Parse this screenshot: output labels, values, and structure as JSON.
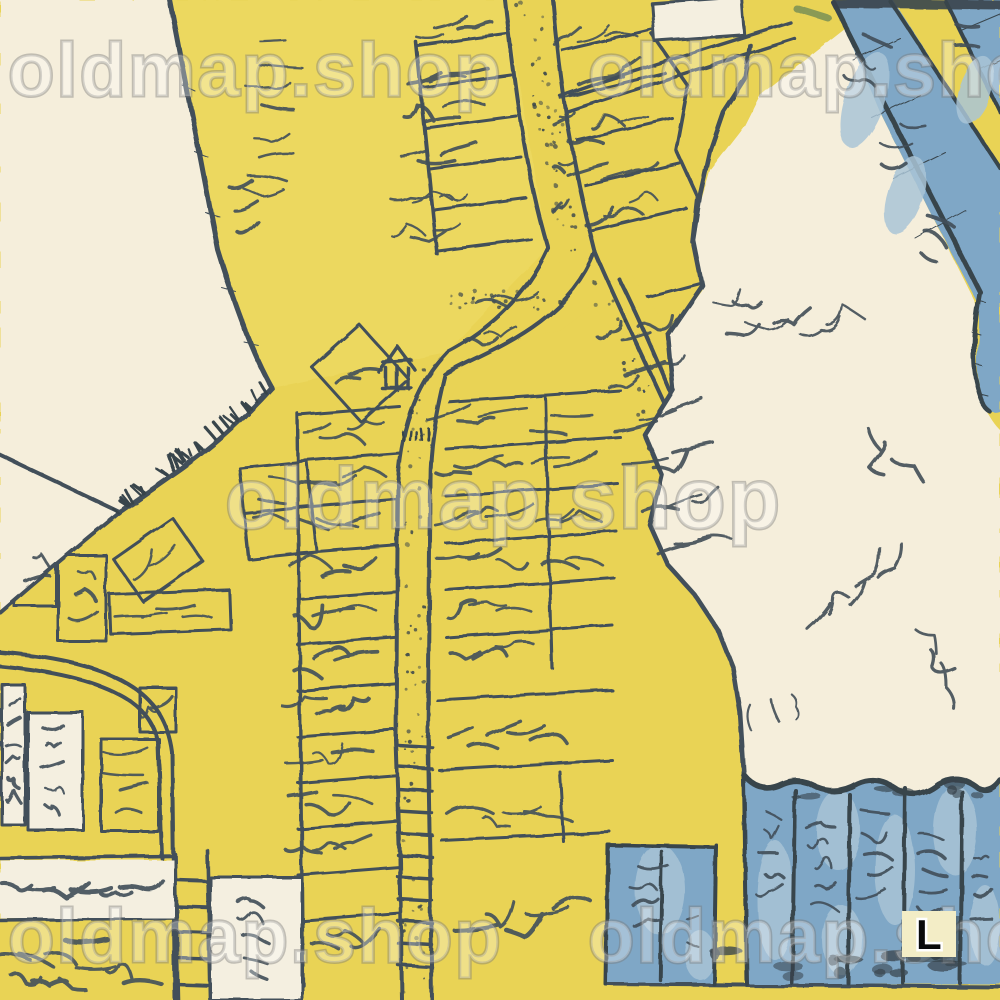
{
  "watermark": {
    "text": "oldmap.shop"
  },
  "badge": {
    "label": "L"
  },
  "colors": {
    "paper": "#f5eedb",
    "land": "#e9d355",
    "landlight": "#efdc66",
    "water": "#7fa7c6",
    "waterlight": "#a9c4d6",
    "inkcol": "#43505a",
    "inkdark": "#38444c",
    "parcelwhite": "#f4efe0",
    "badgebg": "#f3edc6",
    "bridge": "#8a9a55"
  }
}
